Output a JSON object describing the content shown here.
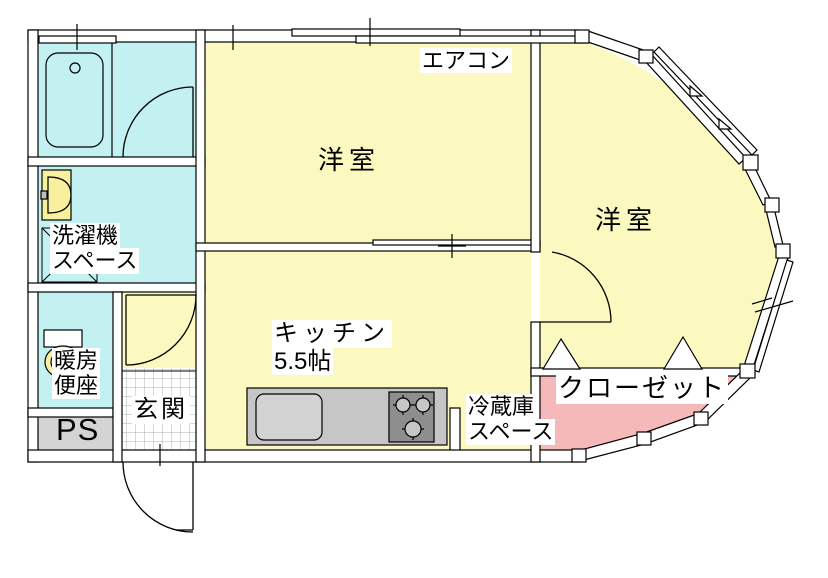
{
  "floorplan": {
    "labels": {
      "aircon": "エアコン",
      "western_room_left": "洋室",
      "western_room_right": "洋室",
      "kitchen": "キッチン",
      "kitchen_size": "5.5帖",
      "washing_machine_line1": "洗濯機",
      "washing_machine_line2": "スペース",
      "heated_seat_line1": "暖房",
      "heated_seat_line2": "便座",
      "pipe_space": "PS",
      "entrance": "玄関",
      "fridge_line1": "冷蔵庫",
      "fridge_line2": "スペース",
      "closet": "クローゼット"
    },
    "colors": {
      "room_yellow": "#fcf9c0",
      "wet_area_cyan": "#c3f1f1",
      "closet_pink": "#f5b9b9",
      "ps_gray": "#d4d4d4",
      "counter_gray": "#c6c6c6",
      "sink_gray": "#d2d2d2",
      "stove_gray": "#8e8e8e",
      "fixture_yellow": "#f8ef9f",
      "tile_line_gray": "#a9b4b4",
      "wall_white": "#ffffff"
    }
  }
}
